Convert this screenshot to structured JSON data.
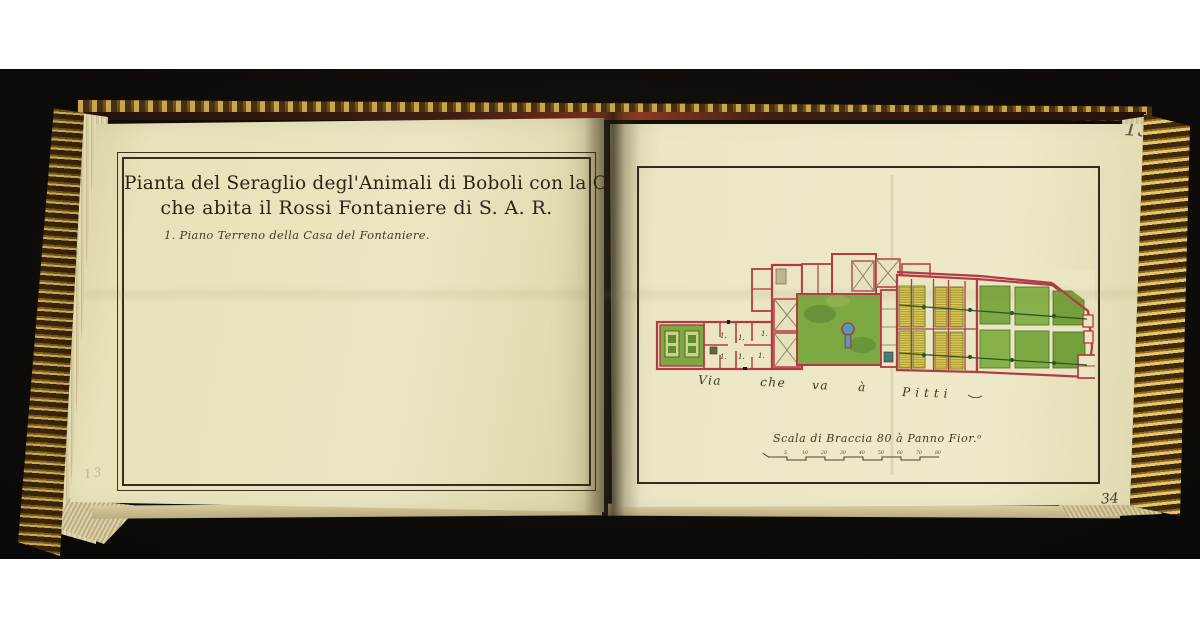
{
  "book": {
    "left_page": {
      "pencil_mark_top": "15",
      "pencil_mark_bottom": "13",
      "title_line1": "Pianta del Seraglio degl'Animali di Boboli con la Casa",
      "title_line2": "che abita il Rossi Fontaniere di S. A. R.",
      "caption": "1. Piano Terreno della Casa del Fontaniere."
    },
    "right_page": {
      "folio_number": "13",
      "page_number": "34",
      "room_number_label": "1.",
      "road_words": [
        "Via",
        "che",
        "va",
        "à",
        "Pitti"
      ],
      "scale_label": "Scala di Braccia 80 à Panno Fior.ᵒ",
      "scale_ticks": [
        "5",
        "10",
        "20",
        "30",
        "40",
        "50",
        "60",
        "70",
        "80"
      ]
    },
    "colors": {
      "paper": "#ebe6c2",
      "ink": "#2c2414",
      "wall_red": "#b23a44",
      "garden_green": "#7da943",
      "bed_yellow": "#ddd06a",
      "water_blue": "#49a0b8",
      "gilt_gold": "#c9a23a",
      "background": "#0b0908"
    }
  }
}
